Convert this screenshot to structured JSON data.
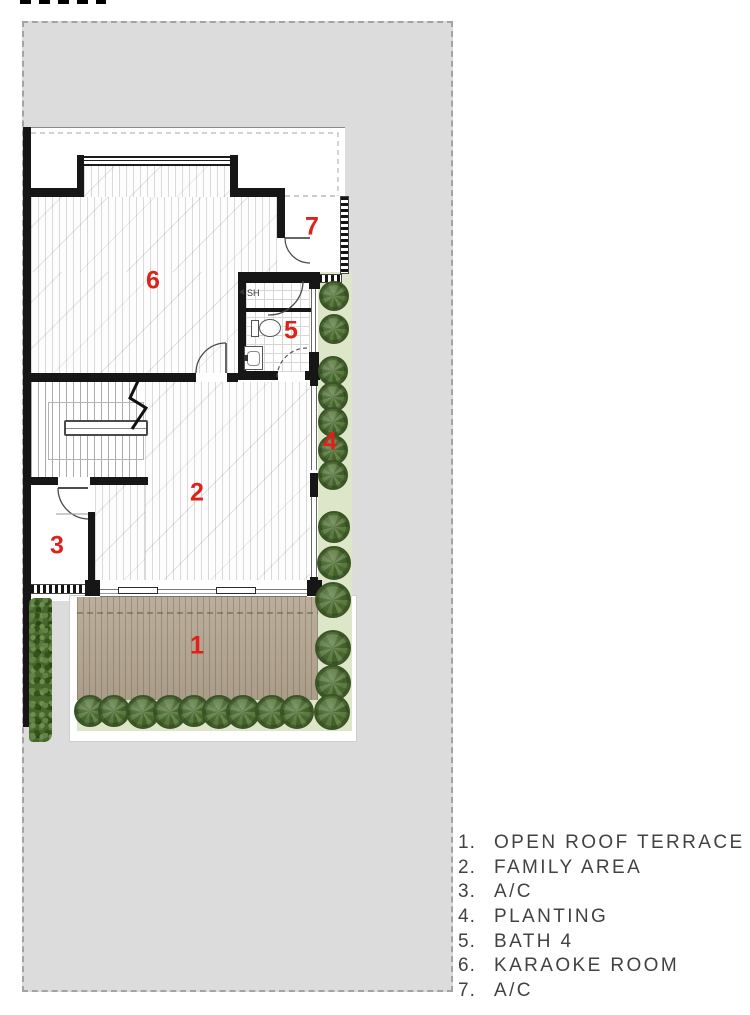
{
  "colors": {
    "site_gray": "#dcdcdc",
    "wall_black": "#161616",
    "deck_tan": "#b3a590",
    "planting_green": "#dde6c9",
    "hedge_green": "#47662c",
    "label_red": "#df2118",
    "legend_text": "#424242"
  },
  "legend": {
    "items": [
      {
        "num": "1.",
        "label": "OPEN ROOF TERRACE"
      },
      {
        "num": "2.",
        "label": "FAMILY AREA"
      },
      {
        "num": "3.",
        "label": "A/C"
      },
      {
        "num": "4.",
        "label": "PLANTING"
      },
      {
        "num": "5.",
        "label": "BATH 4"
      },
      {
        "num": "6.",
        "label": "KARAOKE ROOM"
      },
      {
        "num": "7.",
        "label": "A/C"
      }
    ]
  },
  "plan": {
    "room_labels": [
      {
        "n": "1",
        "x": 197,
        "y": 646
      },
      {
        "n": "2",
        "x": 197,
        "y": 493
      },
      {
        "n": "3",
        "x": 57,
        "y": 546
      },
      {
        "n": "4",
        "x": 330,
        "y": 442
      },
      {
        "n": "5",
        "x": 291,
        "y": 331
      },
      {
        "n": "6",
        "x": 153,
        "y": 281
      },
      {
        "n": "7",
        "x": 312,
        "y": 227
      }
    ],
    "bath": {
      "shower_label": "SH"
    },
    "trees": [
      {
        "x": 334,
        "y": 296,
        "r": 15
      },
      {
        "x": 334,
        "y": 329,
        "r": 15
      },
      {
        "x": 333,
        "y": 371,
        "r": 15
      },
      {
        "x": 333,
        "y": 397,
        "r": 15
      },
      {
        "x": 333,
        "y": 422,
        "r": 15
      },
      {
        "x": 333,
        "y": 450,
        "r": 15
      },
      {
        "x": 333,
        "y": 475,
        "r": 15
      },
      {
        "x": 334,
        "y": 527,
        "r": 16
      },
      {
        "x": 334,
        "y": 563,
        "r": 17
      },
      {
        "x": 333,
        "y": 600,
        "r": 18
      },
      {
        "x": 333,
        "y": 648,
        "r": 18
      },
      {
        "x": 333,
        "y": 683,
        "r": 18
      },
      {
        "x": 332,
        "y": 712,
        "r": 18
      },
      {
        "x": 90,
        "y": 711,
        "r": 16
      },
      {
        "x": 114,
        "y": 711,
        "r": 16
      },
      {
        "x": 143,
        "y": 712,
        "r": 17
      },
      {
        "x": 170,
        "y": 712,
        "r": 17
      },
      {
        "x": 194,
        "y": 711,
        "r": 16
      },
      {
        "x": 219,
        "y": 712,
        "r": 17
      },
      {
        "x": 243,
        "y": 712,
        "r": 17
      },
      {
        "x": 272,
        "y": 712,
        "r": 17
      },
      {
        "x": 297,
        "y": 712,
        "r": 17
      }
    ]
  }
}
